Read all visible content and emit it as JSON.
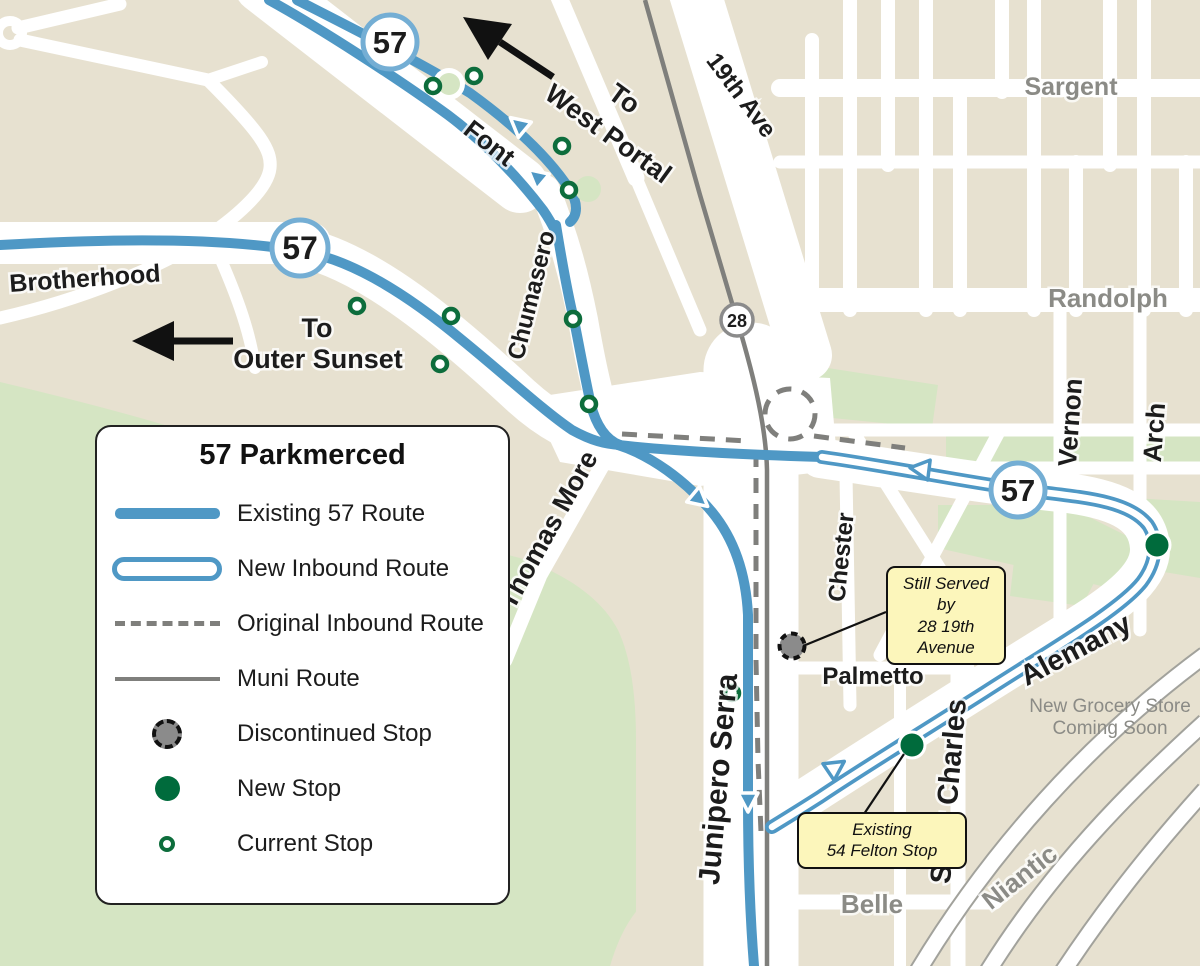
{
  "legend": {
    "title": "57 Parkmerced",
    "items": [
      {
        "label": "Existing 57 Route",
        "type": "existing-route"
      },
      {
        "label": "New Inbound Route",
        "type": "new-inbound-route"
      },
      {
        "label": "Original Inbound Route",
        "type": "original-inbound-route"
      },
      {
        "label": "Muni Route",
        "type": "muni-route"
      },
      {
        "label": "Discontinued Stop",
        "type": "discontinued-stop"
      },
      {
        "label": "New Stop",
        "type": "new-stop"
      },
      {
        "label": "Current Stop",
        "type": "current-stop"
      }
    ]
  },
  "badges": {
    "route57": "57",
    "route28": "28"
  },
  "streets": {
    "brotherhood": "Brotherhood",
    "font": "Font",
    "chumasero": "Chumasero",
    "thomas_more": "Thomas More",
    "junipero_serra": "Junipero Serra",
    "nineteenth_ave": "19th Ave",
    "sargent": "Sargent",
    "randolph": "Randolph",
    "vernon": "Vernon",
    "arch": "Arch",
    "chester": "Chester",
    "palmetto": "Palmetto",
    "alemany": "Alemany",
    "saint_charles": "Saint Charles",
    "belle": "Belle",
    "niantic": "Niantic"
  },
  "annotations": {
    "to_west_portal_line1": "To",
    "to_west_portal_line2": "West Portal",
    "to_outer_sunset_line1": "To",
    "to_outer_sunset_line2": "Outer Sunset",
    "grocery_line1": "New Grocery Store",
    "grocery_line2": "Coming Soon"
  },
  "callouts": {
    "still_served": {
      "line1": "Still Served by",
      "line2": "28 19th",
      "line3": "Avenue"
    },
    "existing_felton": {
      "line1": "Existing",
      "line2": "54 Felton Stop"
    }
  },
  "stops": {
    "current": [
      [
        433,
        86
      ],
      [
        474,
        76
      ],
      [
        562,
        146
      ],
      [
        569,
        190
      ],
      [
        357,
        306
      ],
      [
        451,
        316
      ],
      [
        440,
        364
      ],
      [
        573,
        319
      ],
      [
        589,
        404
      ],
      [
        732,
        693
      ]
    ],
    "new": [
      [
        1157,
        545
      ],
      [
        912,
        745
      ]
    ],
    "discontinued": [
      [
        792,
        646
      ]
    ]
  },
  "colors": {
    "tan": "#e7e1d0",
    "green": "#d5e5c3",
    "blue": "#4f98c5",
    "gray": "#7f7f7c",
    "darkgreen": "#006b3c",
    "ringgreen": "#0d6d3c",
    "yellow": "#fcf6bb",
    "graylabel": "#8b8b86",
    "ink": "#1c1c1c"
  }
}
